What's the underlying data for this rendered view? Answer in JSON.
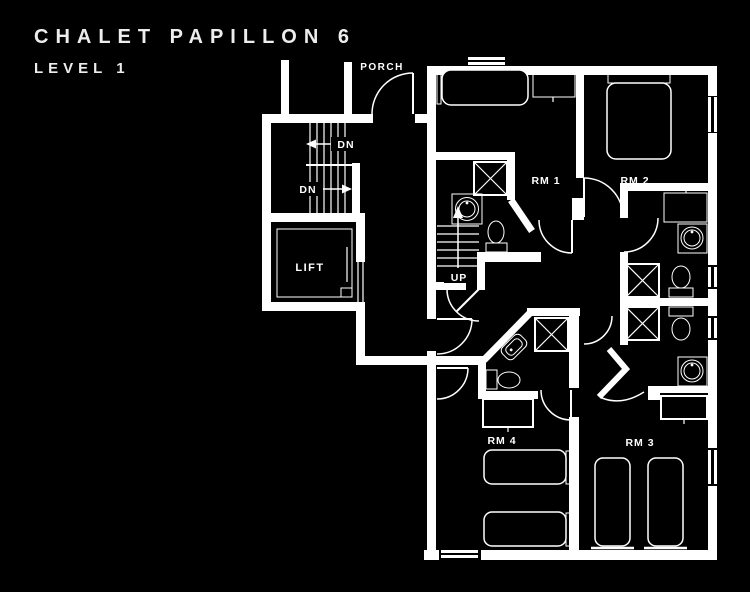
{
  "title": "CHALET PAPILLON 6",
  "subtitle": "LEVEL 1",
  "colors": {
    "background": "#000000",
    "line": "#ffffff",
    "text": "#ededed"
  },
  "plan": {
    "porch_label": "PORCH",
    "stairs_down_label_1": "DN",
    "stairs_down_label_2": "DN",
    "stairs_up_label": "UP",
    "lift_label": "LIFT",
    "room_labels": {
      "rm1": "RM 1",
      "rm2": "RM 2",
      "rm3": "RM 3",
      "rm4": "RM 4"
    }
  }
}
